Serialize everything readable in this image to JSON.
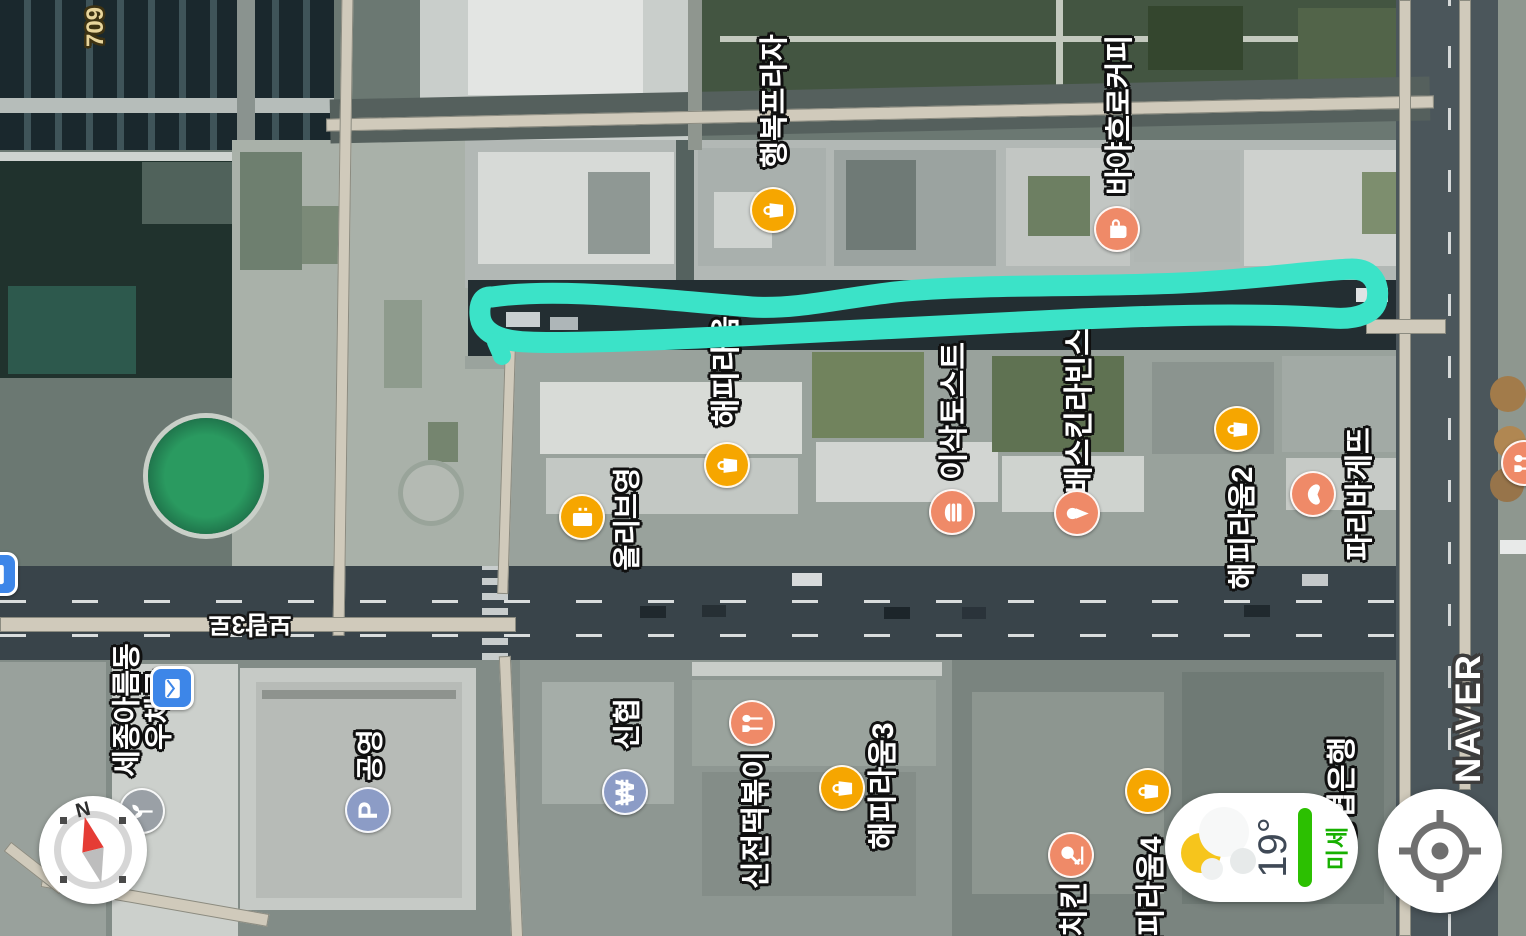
{
  "app": {
    "watermark": "NAVER"
  },
  "controls": {
    "compass": {
      "north_label": "N"
    },
    "weather": {
      "temperature": "19°",
      "air_quality": "미세"
    },
    "location": {
      "tooltip": ""
    }
  },
  "annotation": {
    "color": "#3BE3C8"
  },
  "road_labels": [
    {
      "text": "709",
      "cx": 96,
      "cy": 27,
      "rot": -90,
      "style": "route-number",
      "size": 24
    },
    {
      "text": "보람3로",
      "cx": 250,
      "cy": 626,
      "rot": 180,
      "style": "road-name",
      "size": 25
    }
  ],
  "pois": [
    {
      "name": "행복프라자",
      "label": {
        "cx": 775,
        "cy": 101,
        "size": 29
      },
      "marker": {
        "x": 773,
        "y": 210,
        "color": "#F6A600",
        "icon": "bag-icon"
      }
    },
    {
      "name": "바야흐로커피",
      "label": {
        "cx": 1120,
        "cy": 115,
        "size": 29
      },
      "marker": {
        "x": 1117,
        "y": 229,
        "color": "#EF8A68",
        "icon": "cup-icon"
      }
    },
    {
      "name": "해피라움",
      "label": {
        "cx": 727,
        "cy": 371,
        "size": 30
      },
      "marker": {
        "x": 727,
        "y": 465,
        "color": "#F6A600",
        "icon": "bag-icon"
      }
    },
    {
      "name": "이삭토스트",
      "label": {
        "cx": 955,
        "cy": 411,
        "size": 30
      },
      "marker": {
        "x": 952,
        "y": 512,
        "color": "#EF8A68",
        "icon": "burger-icon"
      }
    },
    {
      "name": "배스킨라빈스",
      "label": {
        "cx": 1080,
        "cy": 411,
        "size": 30
      },
      "marker": {
        "x": 1077,
        "y": 513,
        "color": "#EF8A68",
        "icon": "icecream-icon"
      }
    },
    {
      "name": "해피라움2",
      "label": {
        "cx": 1243,
        "cy": 528,
        "size": 29
      },
      "marker": {
        "x": 1237,
        "y": 429,
        "color": "#F6A600",
        "icon": "bag-icon"
      }
    },
    {
      "name": "파리바게뜨",
      "label": {
        "cx": 1360,
        "cy": 494,
        "size": 29
      },
      "marker": {
        "x": 1313,
        "y": 494,
        "color": "#EF8A68",
        "icon": "bread-icon"
      }
    },
    {
      "name": "올리브영",
      "label": {
        "cx": 627,
        "cy": 519,
        "size": 28
      },
      "marker": {
        "x": 582,
        "y": 517,
        "color": "#F6A600",
        "icon": "store-icon"
      }
    },
    {
      "name": "세종아름동\n우체국",
      "label": {
        "cx": 144,
        "cy": 710,
        "size": 29
      },
      "marker": {
        "x": 172,
        "y": 688,
        "color": "#3D86E8",
        "icon": "mail-icon",
        "shape": "square"
      }
    },
    {
      "name": "공영",
      "label": {
        "cx": 370,
        "cy": 755,
        "size": 28
      },
      "marker": {
        "x": 368,
        "y": 810,
        "color": "#8C9CC6",
        "icon": "parking-icon"
      }
    },
    {
      "name": "신협",
      "label": {
        "cx": 627,
        "cy": 724,
        "size": 28
      },
      "marker": {
        "x": 625,
        "y": 792,
        "color": "#8C9CC6",
        "icon": "won-icon"
      }
    },
    {
      "name": "신전떡볶이",
      "label": {
        "cx": 757,
        "cy": 820,
        "size": 30
      },
      "marker": {
        "x": 752,
        "y": 723,
        "color": "#EF8A68",
        "icon": "fork-spoon-icon"
      }
    },
    {
      "name": "해피라움3",
      "label": {
        "cx": 884,
        "cy": 786,
        "size": 30
      },
      "marker": {
        "x": 842,
        "y": 788,
        "color": "#F6A600",
        "icon": "bag-icon"
      }
    },
    {
      "name": "치킨",
      "label": {
        "cx": 1075,
        "cy": 909,
        "size": 30
      },
      "marker": {
        "x": 1071,
        "y": 855,
        "color": "#EF8A68",
        "icon": "chicken-icon"
      }
    },
    {
      "name": "해피라움4",
      "label": {
        "cx": 1152,
        "cy": 900,
        "size": 30
      },
      "marker": {
        "x": 1148,
        "y": 791,
        "color": "#F6A600",
        "icon": "bag-icon"
      }
    },
    {
      "name": "농협은행",
      "label": {
        "cx": 1343,
        "cy": 792,
        "size": 30
      },
      "marker": null
    },
    {
      "name": "",
      "label": null,
      "marker": {
        "x": 142,
        "y": 811,
        "color": "#9AA0A6",
        "icon": "plant-icon"
      }
    },
    {
      "name": "",
      "label": null,
      "marker": {
        "x": 1524,
        "y": 463,
        "color": "#EF8A68",
        "icon": "fork-spoon-icon"
      }
    },
    {
      "name": "",
      "label": null,
      "marker": {
        "x": -4,
        "y": 574,
        "color": "#3D86E8",
        "icon": "mail-icon",
        "shape": "square"
      }
    }
  ]
}
